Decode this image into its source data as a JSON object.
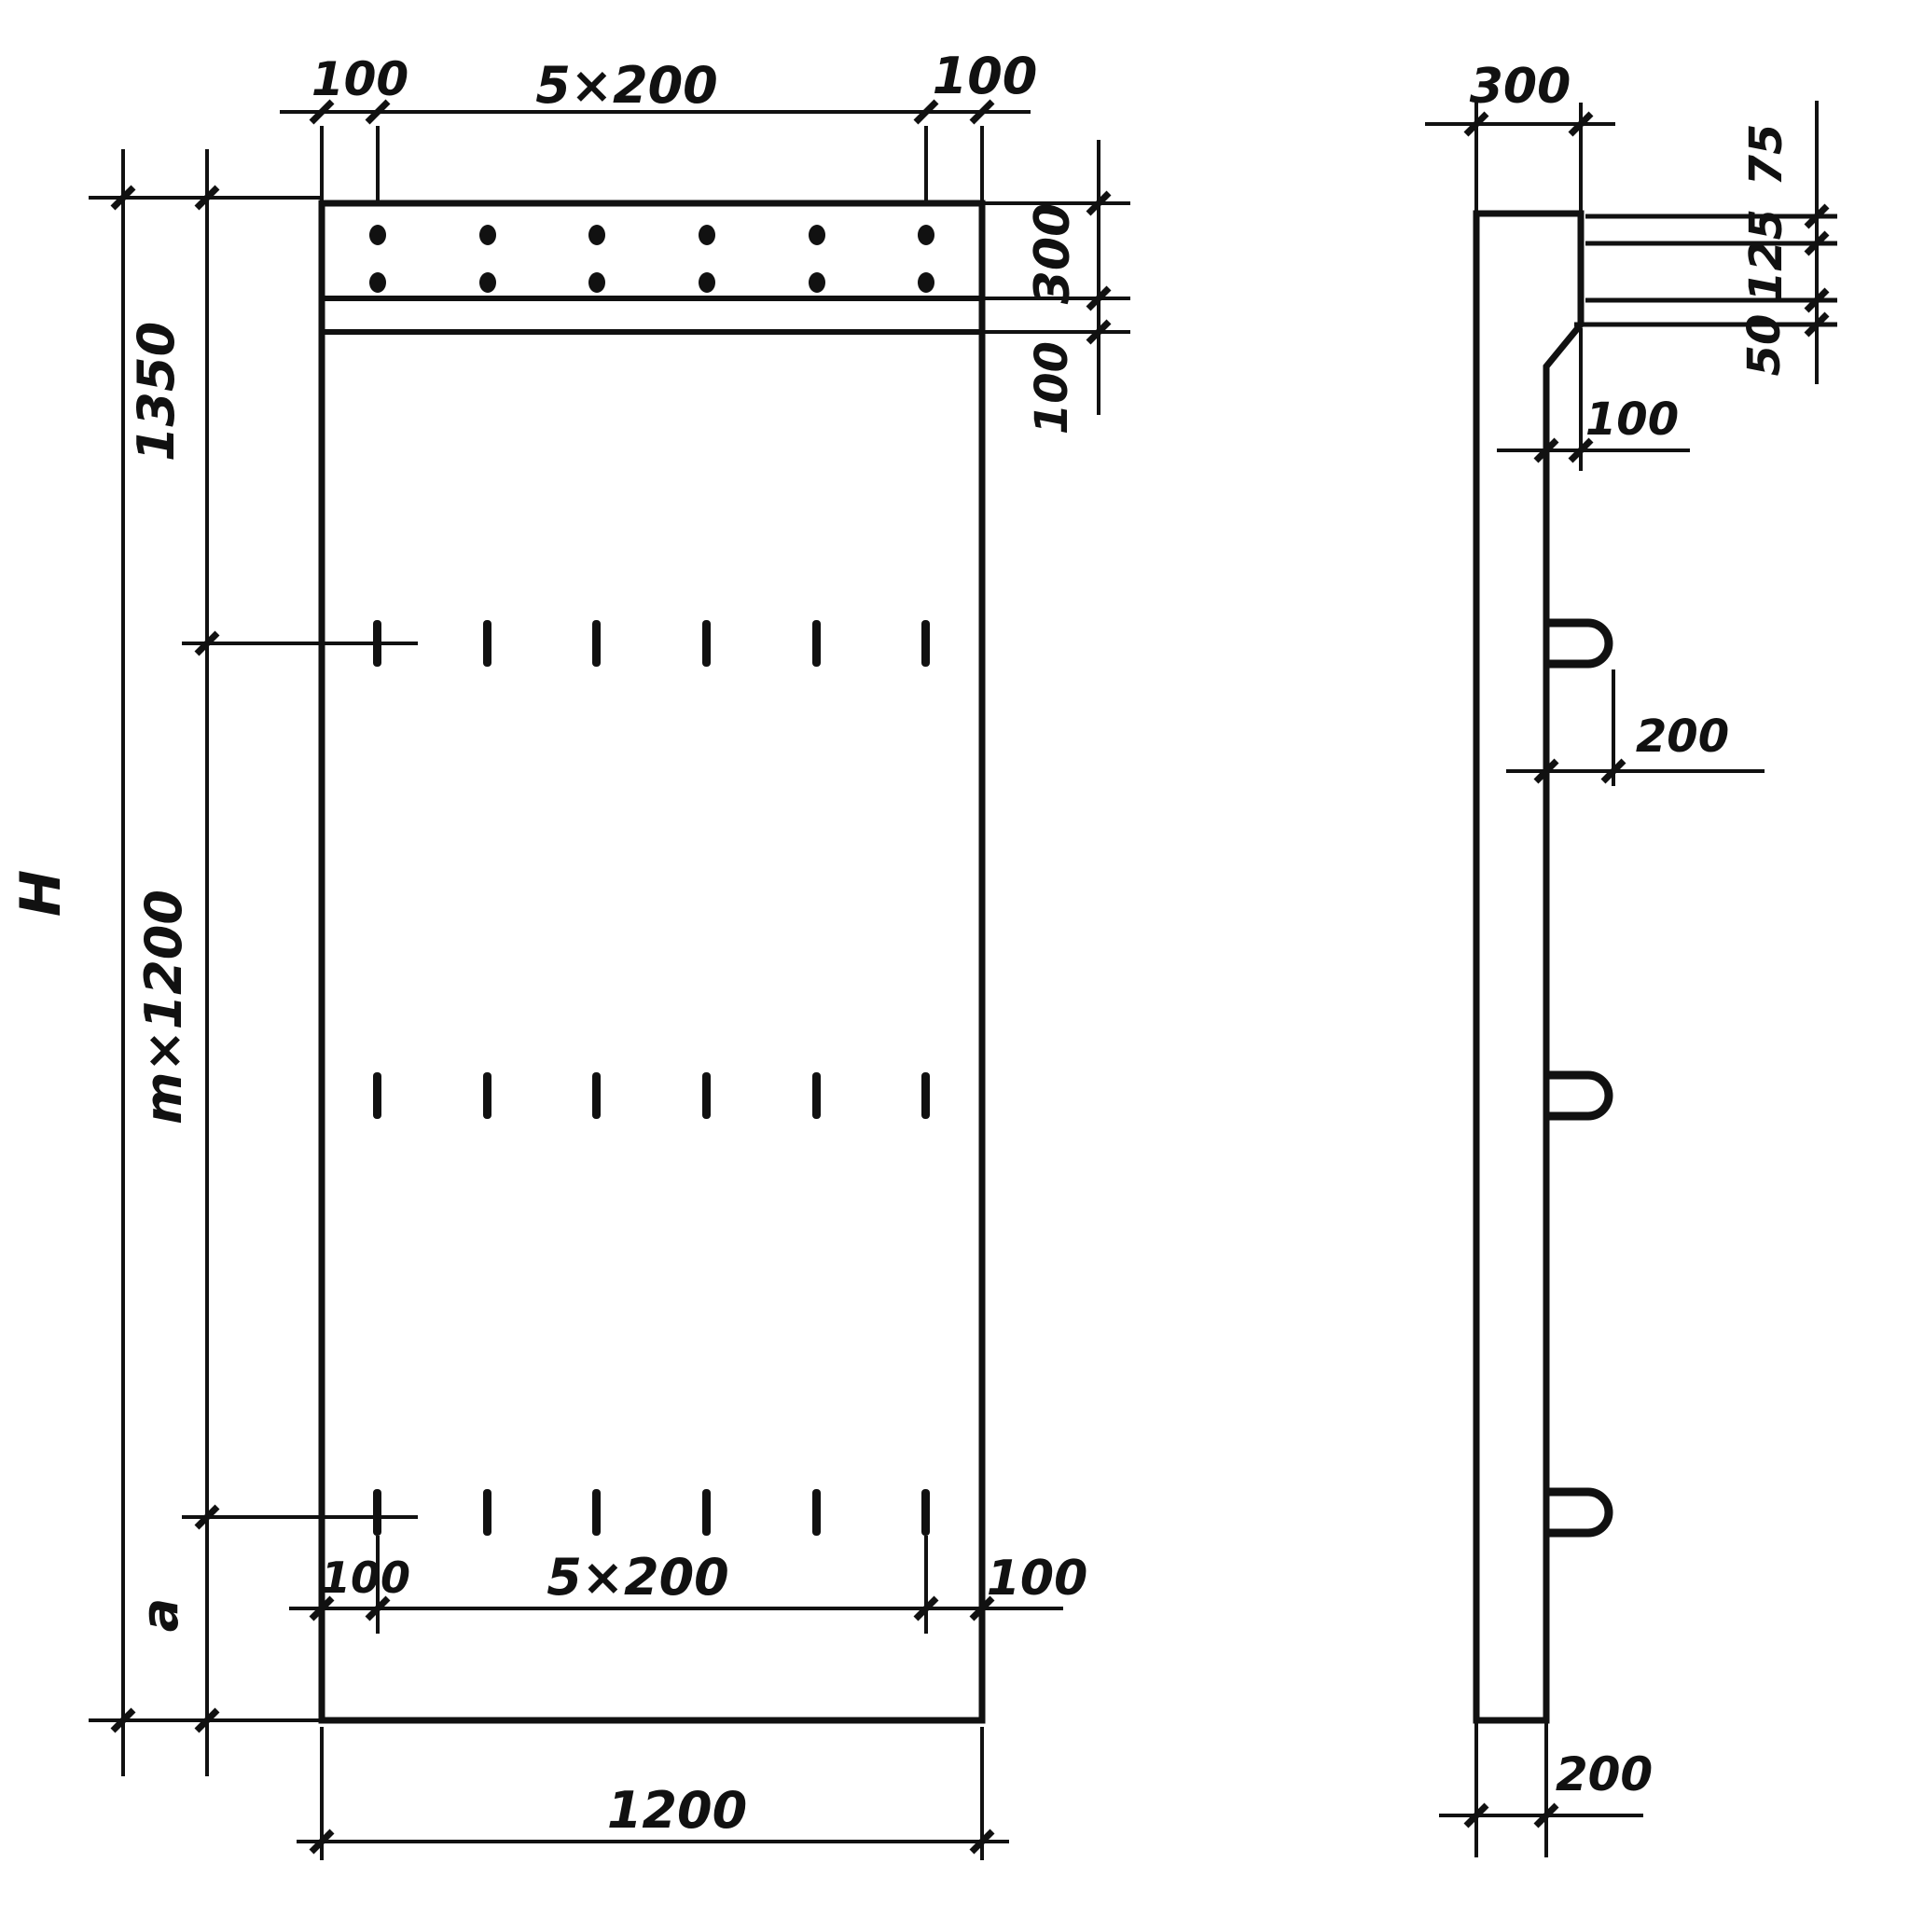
{
  "drawing": {
    "sheet_name": "reinforced-concrete-panel-two-view-dimension-drawing",
    "front_view": {
      "top_dims": {
        "left": "100",
        "middle": "5×200",
        "right": "100"
      },
      "right_dims": {
        "band_height": "300",
        "strip_height": "100"
      },
      "left_dims": {
        "top_segment": "1350",
        "overall_height": "H",
        "middle_segment": "m×1200",
        "bottom_segment": "a"
      },
      "bottom_dims": {
        "left": "100",
        "middle": "5×200",
        "right": "100",
        "overall_width": "1200"
      }
    },
    "side_view": {
      "top_thickness": "300",
      "right_dims": {
        "first": "75",
        "second": "125",
        "third": "50"
      },
      "taper_offset": "100",
      "hook_length": "200",
      "bottom_thickness": "200"
    }
  }
}
